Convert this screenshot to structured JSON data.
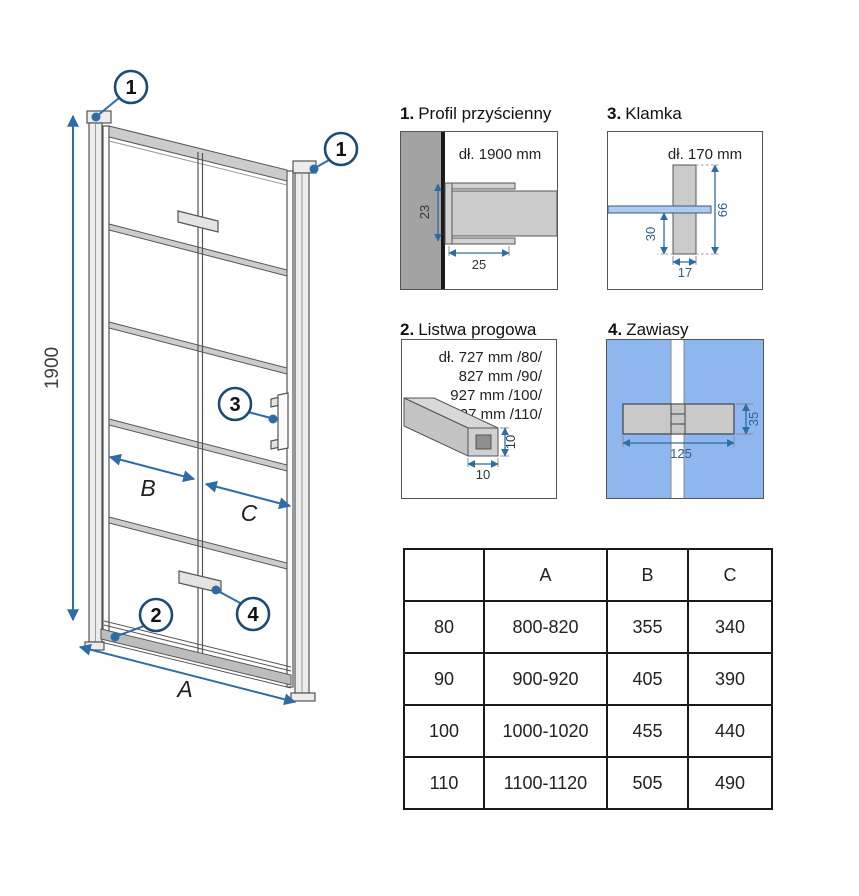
{
  "colors": {
    "accent_blue": "#2e6da4",
    "callout_ring": "#1d4b75",
    "glass_blue": "#aecbee",
    "hinge_panel_blue": "#8db7ee",
    "wall_gray": "#a3a3a3",
    "profile_gray": "#cccccc"
  },
  "diagram": {
    "height_label": "1900",
    "width_label": "A",
    "left_panel_label": "B",
    "right_panel_label": "C",
    "callout_wall_profile_left": "1",
    "callout_wall_profile_right": "1",
    "callout_threshold": "2",
    "callout_handle": "3",
    "callout_hinge": "4"
  },
  "details": [
    {
      "num": "1.",
      "title": "Profil przyścienny",
      "length": "dł. 1900 mm",
      "dim_height": "23",
      "dim_width": "25"
    },
    {
      "num": "2.",
      "title": "Listwa progowa",
      "lengths": [
        "dł. 727 mm /80/",
        "827 mm /90/",
        "927 mm /100/",
        "1027 mm /110/"
      ],
      "dim_height": "10",
      "dim_width": "10"
    },
    {
      "num": "3.",
      "title": "Klamka",
      "length": "dł. 170 mm",
      "dim_total": "66",
      "dim_lower": "30",
      "dim_width": "17"
    },
    {
      "num": "4.",
      "title": "Zawiasy",
      "dim_length": "125",
      "dim_height": "35"
    }
  ],
  "table": {
    "headers": [
      "",
      "A",
      "B",
      "C"
    ],
    "rows": [
      [
        "80",
        "800-820",
        "355",
        "340"
      ],
      [
        "90",
        "900-920",
        "405",
        "390"
      ],
      [
        "100",
        "1000-1020",
        "455",
        "440"
      ],
      [
        "110",
        "1100-1120",
        "505",
        "490"
      ]
    ]
  }
}
